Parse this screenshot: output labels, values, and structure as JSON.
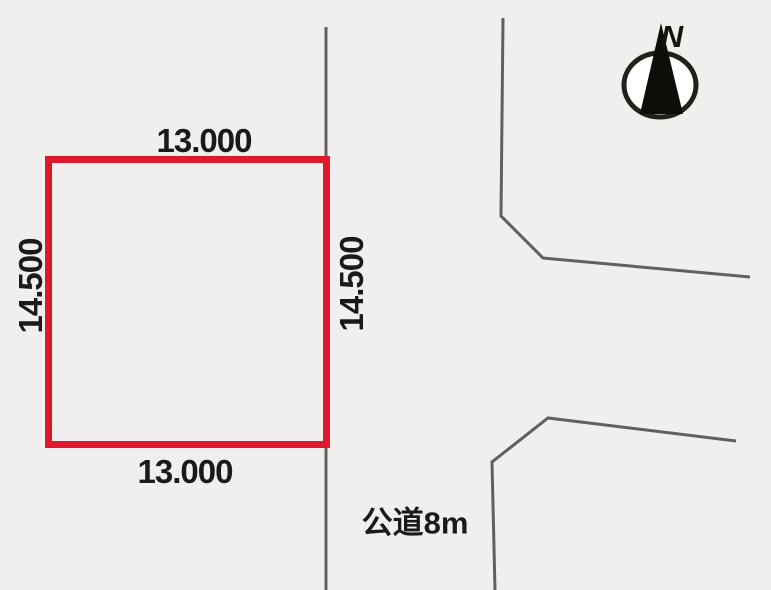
{
  "diagram": {
    "type": "land-plot-site-plan",
    "plot": {
      "dimensions": {
        "top": "13.000",
        "bottom": "13.000",
        "left": "14.500",
        "right": "14.500"
      }
    },
    "road": {
      "label": "公道8m"
    },
    "compass": {
      "label": "N"
    },
    "colors": {
      "background": "#f0efee",
      "plot_border": "#e0182b",
      "road_line": "#606060",
      "text": "#1a1a1a",
      "compass": "#23221a"
    }
  }
}
